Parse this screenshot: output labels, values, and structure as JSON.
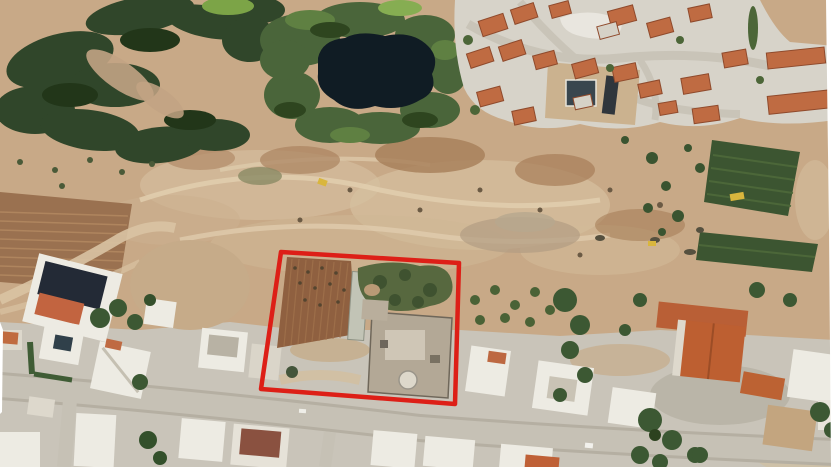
{
  "meta": {
    "type": "aerial-satellite-photo",
    "description": "Aerial satellite view of a development area: land plot outlined in red beside a road, with residential estate, pond, forest and graded construction ground"
  },
  "boundary": {
    "color": "#dd1f17",
    "stroke_width": "4.5",
    "points": "281,252 459,263 455,404 261,389"
  },
  "palette": {
    "dirt": "#c8a987",
    "dirt_light": "#d8c2a2",
    "dirt_dark": "#a67e59",
    "forest": "#30462a",
    "vegetation": "#4a653a",
    "pond": "#101c24",
    "concrete": "#d7d3c9",
    "road": "#c6c1b5",
    "roof_orange": "#bf6b42",
    "roof_terracotta": "#bd5f31",
    "roof_navy": "#232a36",
    "building_white": "#edebe3",
    "building_gray": "#b7b1a4",
    "tree_green": "#3c5833",
    "orchard": "#3c5531",
    "field_brown": "#9a7150",
    "plot_field": "#8f6040",
    "machine_yellow": "#d9b63d",
    "frame_white": "#ffffff"
  },
  "features": [
    "forest-top-left",
    "pond",
    "residential-estate",
    "construction-dirt-area",
    "orchard-rows",
    "plowed-field",
    "plot-boundary",
    "plot-field",
    "greenhouse",
    "building-under-construction",
    "main-road",
    "village-houses",
    "excavators"
  ]
}
